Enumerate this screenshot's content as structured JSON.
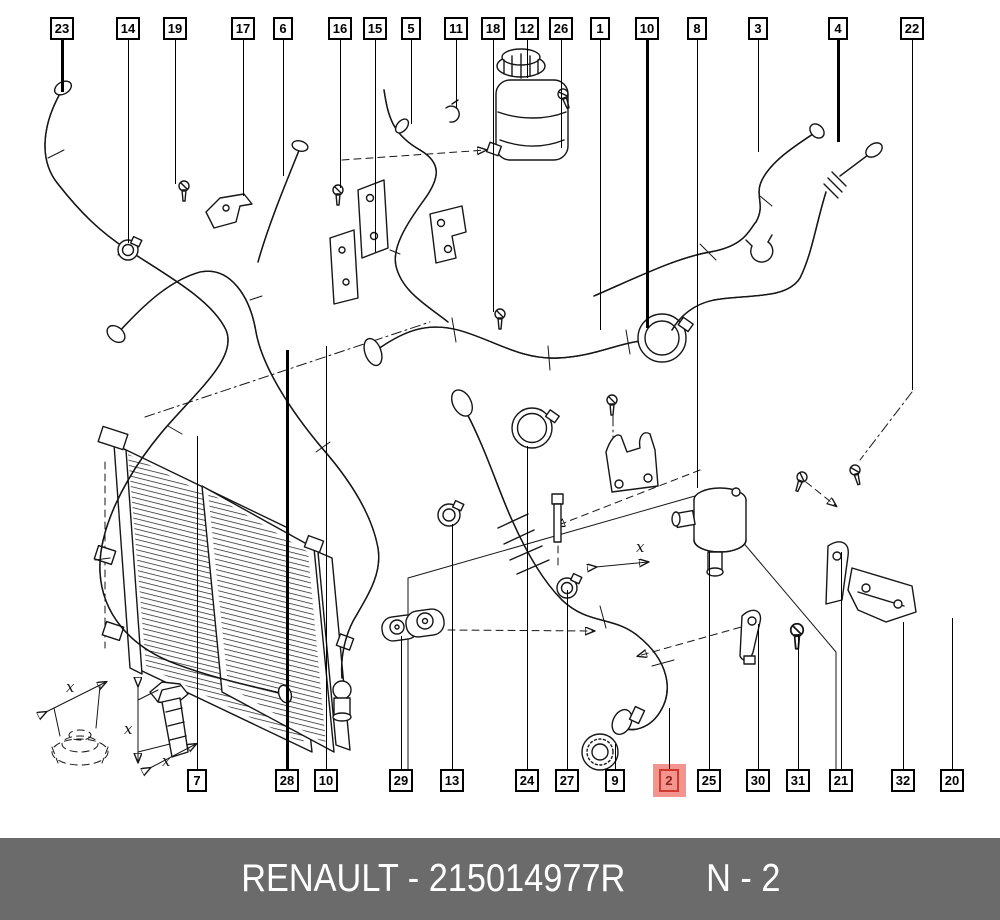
{
  "diagram": {
    "description": "Renault engine cooling hoses exploded parts diagram",
    "highlighted_part": "2",
    "callouts": {
      "top": [
        {
          "label": "23",
          "x": 62,
          "to": 92,
          "bold": true
        },
        {
          "label": "14",
          "x": 128,
          "to": 243
        },
        {
          "label": "19",
          "x": 175,
          "to": 184
        },
        {
          "label": "17",
          "x": 243,
          "to": 196
        },
        {
          "label": "6",
          "x": 283,
          "to": 176
        },
        {
          "label": "16",
          "x": 340,
          "to": 188
        },
        {
          "label": "15",
          "x": 375,
          "to": 252
        },
        {
          "label": "5",
          "x": 411,
          "to": 124
        },
        {
          "label": "11",
          "x": 456,
          "to": 108
        },
        {
          "label": "18",
          "x": 493,
          "to": 312
        },
        {
          "label": "12",
          "x": 527,
          "to": 78
        },
        {
          "label": "26",
          "x": 561,
          "to": 148
        },
        {
          "label": "1",
          "x": 600,
          "to": 330
        },
        {
          "label": "10",
          "x": 647,
          "to": 328,
          "bold": true
        },
        {
          "label": "8",
          "x": 697,
          "to": 488
        },
        {
          "label": "3",
          "x": 758,
          "to": 152
        },
        {
          "label": "4",
          "x": 838,
          "to": 142,
          "bold": true
        },
        {
          "label": "22",
          "x": 912,
          "to": 390
        }
      ],
      "bottom": [
        {
          "label": "7",
          "x": 197,
          "to": 436
        },
        {
          "label": "28",
          "x": 287,
          "to": 350,
          "bold": true
        },
        {
          "label": "10",
          "x": 326,
          "to": 346
        },
        {
          "label": "29",
          "x": 401,
          "to": 636
        },
        {
          "label": "13",
          "x": 452,
          "to": 524
        },
        {
          "label": "24",
          "x": 527,
          "to": 446
        },
        {
          "label": "27",
          "x": 567,
          "to": 590
        },
        {
          "label": "9",
          "x": 615,
          "to": 744
        },
        {
          "label": "2",
          "x": 669,
          "to": 708,
          "highlight": true
        },
        {
          "label": "25",
          "x": 709,
          "to": 552
        },
        {
          "label": "30",
          "x": 758,
          "to": 624
        },
        {
          "label": "31",
          "x": 798,
          "to": 634
        },
        {
          "label": "21",
          "x": 841,
          "to": 552
        },
        {
          "label": "32",
          "x": 903,
          "to": 622
        },
        {
          "label": "20",
          "x": 952,
          "to": 618
        }
      ]
    },
    "annotations": {
      "dim_label": "x"
    }
  },
  "colors": {
    "paper": "#ffffff",
    "line": "#161616",
    "footer_bg": "#6b6b6b",
    "footer_text": "#ffffff",
    "highlight_fill": "#f4948e",
    "highlight_border": "#cf3a2e",
    "highlight_text": "#8c221a"
  },
  "footer": {
    "brand": "RENAULT",
    "separator": "-",
    "part_number": "215014977R",
    "left_text": "RENAULT - 215014977R",
    "page_ref": "N - 2"
  }
}
